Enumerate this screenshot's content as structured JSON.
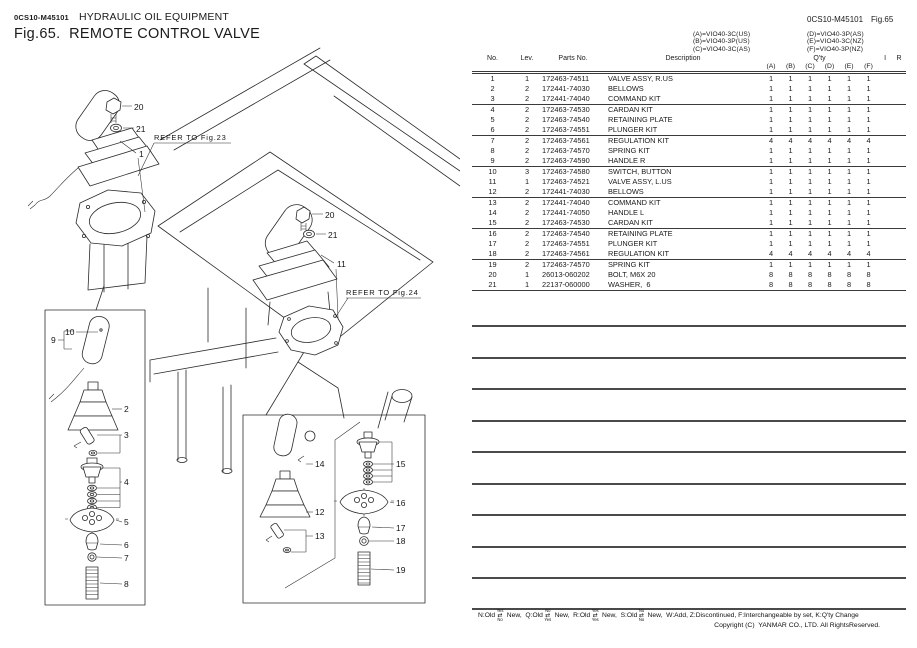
{
  "header": {
    "doc_code": "0CS10-M45101",
    "section": "HYDRAULIC OIL EQUIPMENT",
    "fig_title": "Fig.65.  REMOTE CONTROL VALVE",
    "doc_code_right": "0CS10-M45101",
    "fig_no_right": "Fig.65"
  },
  "models": {
    "left": [
      "(A)=VIO40-3C(US)",
      "(B)=VIO40-3P(US)",
      "(C)=VIO40-3C(AS)"
    ],
    "right": [
      "(D)=VIO40-3P(AS)",
      "(E)=VIO40-3C(NZ)",
      "(F)=VIO40-3P(NZ)"
    ]
  },
  "table": {
    "headers": {
      "no": "No.",
      "lev": "Lev.",
      "parts_no": "Parts No.",
      "description": "Description",
      "qty": "Q'ty",
      "i": "I",
      "r": "R",
      "qty_cols": [
        "(A)",
        "(B)",
        "(C)",
        "(D)",
        "(E)",
        "(F)"
      ]
    },
    "rows": [
      {
        "no": "1",
        "lev": "1",
        "parts_no": "172463-74511",
        "description": "VALVE ASSY, R.US",
        "qty": [
          "1",
          "1",
          "1",
          "1",
          "1",
          "1"
        ]
      },
      {
        "no": "2",
        "lev": "2",
        "parts_no": "172441-74030",
        "description": "BELLOWS",
        "qty": [
          "1",
          "1",
          "1",
          "1",
          "1",
          "1"
        ]
      },
      {
        "no": "3",
        "lev": "2",
        "parts_no": "172441-74040",
        "description": "COMMAND KIT",
        "qty": [
          "1",
          "1",
          "1",
          "1",
          "1",
          "1"
        ]
      },
      {
        "no": "4",
        "lev": "2",
        "parts_no": "172463-74530",
        "description": "CARDAN KIT",
        "qty": [
          "1",
          "1",
          "1",
          "1",
          "1",
          "1"
        ]
      },
      {
        "no": "5",
        "lev": "2",
        "parts_no": "172463-74540",
        "description": "RETAINING PLATE",
        "qty": [
          "1",
          "1",
          "1",
          "1",
          "1",
          "1"
        ]
      },
      {
        "no": "6",
        "lev": "2",
        "parts_no": "172463-74551",
        "description": "PLUNGER KIT",
        "qty": [
          "1",
          "1",
          "1",
          "1",
          "1",
          "1"
        ]
      },
      {
        "no": "7",
        "lev": "2",
        "parts_no": "172463-74561",
        "description": "REGULATION KIT",
        "qty": [
          "4",
          "4",
          "4",
          "4",
          "4",
          "4"
        ]
      },
      {
        "no": "8",
        "lev": "2",
        "parts_no": "172463-74570",
        "description": "SPRING KIT",
        "qty": [
          "1",
          "1",
          "1",
          "1",
          "1",
          "1"
        ]
      },
      {
        "no": "9",
        "lev": "2",
        "parts_no": "172463-74590",
        "description": "HANDLE R",
        "qty": [
          "1",
          "1",
          "1",
          "1",
          "1",
          "1"
        ]
      },
      {
        "no": "10",
        "lev": "3",
        "parts_no": "172463-74580",
        "description": "SWITCH, BUTTON",
        "qty": [
          "1",
          "1",
          "1",
          "1",
          "1",
          "1"
        ]
      },
      {
        "no": "11",
        "lev": "1",
        "parts_no": "172463-74521",
        "description": "VALVE ASSY, L.US",
        "qty": [
          "1",
          "1",
          "1",
          "1",
          "1",
          "1"
        ]
      },
      {
        "no": "12",
        "lev": "2",
        "parts_no": "172441-74030",
        "description": "BELLOWS",
        "qty": [
          "1",
          "1",
          "1",
          "1",
          "1",
          "1"
        ]
      },
      {
        "no": "13",
        "lev": "2",
        "parts_no": "172441-74040",
        "description": "COMMAND KIT",
        "qty": [
          "1",
          "1",
          "1",
          "1",
          "1",
          "1"
        ]
      },
      {
        "no": "14",
        "lev": "2",
        "parts_no": "172441-74050",
        "description": "HANDLE L",
        "qty": [
          "1",
          "1",
          "1",
          "1",
          "1",
          "1"
        ]
      },
      {
        "no": "15",
        "lev": "2",
        "parts_no": "172463-74530",
        "description": "CARDAN KIT",
        "qty": [
          "1",
          "1",
          "1",
          "1",
          "1",
          "1"
        ]
      },
      {
        "no": "16",
        "lev": "2",
        "parts_no": "172463-74540",
        "description": "RETAINING PLATE",
        "qty": [
          "1",
          "1",
          "1",
          "1",
          "1",
          "1"
        ]
      },
      {
        "no": "17",
        "lev": "2",
        "parts_no": "172463-74551",
        "description": "PLUNGER KIT",
        "qty": [
          "1",
          "1",
          "1",
          "1",
          "1",
          "1"
        ]
      },
      {
        "no": "18",
        "lev": "2",
        "parts_no": "172463-74561",
        "description": "REGULATION KIT",
        "qty": [
          "4",
          "4",
          "4",
          "4",
          "4",
          "4"
        ]
      },
      {
        "no": "19",
        "lev": "2",
        "parts_no": "172463-74570",
        "description": "SPRING KIT",
        "qty": [
          "1",
          "1",
          "1",
          "1",
          "1",
          "1"
        ]
      },
      {
        "no": "20",
        "lev": "1",
        "parts_no": "26013-060202",
        "description": "BOLT, M6X 20",
        "qty": [
          "8",
          "8",
          "8",
          "8",
          "8",
          "8"
        ]
      },
      {
        "no": "21",
        "lev": "1",
        "parts_no": "22137-060000",
        "description": "WASHER,  6",
        "qty": [
          "8",
          "8",
          "8",
          "8",
          "8",
          "8"
        ]
      }
    ]
  },
  "diagram": {
    "refer_fig23": "REFER TO Fig.23",
    "refer_fig24": "REFER TO Fig.24",
    "callouts": {
      "n1": "1",
      "n2": "2",
      "n3": "3",
      "n4": "4",
      "n5": "5",
      "n6": "6",
      "n7": "7",
      "n8": "8",
      "n9": "9",
      "n10": "10",
      "n11": "11",
      "n12": "12",
      "n13": "13",
      "n14": "14",
      "n15": "15",
      "n16": "16",
      "n17": "17",
      "n18": "18",
      "n19": "19",
      "n20": "20",
      "n21": "21"
    }
  },
  "footer": {
    "codes": [
      {
        "label": "N:Old",
        "top": "Yes",
        "bottom": "No",
        "suffix": " New,  "
      },
      {
        "label": "Q:Old",
        "top": "No",
        "bottom": "Yes",
        "suffix": " New,  "
      },
      {
        "label": "R:Old",
        "top": "Yes",
        "bottom": "Yes",
        "suffix": " New,  "
      },
      {
        "label": "S:Old",
        "top": "No",
        "bottom": "No",
        "suffix": " New,  "
      }
    ],
    "tail": "W:Add, Z:Discontinued, F:Interchangeable by set, K:Q'ty Change",
    "copyright": "Copyright (C)  YANMAR CO., LTD. All RightsReserved."
  }
}
